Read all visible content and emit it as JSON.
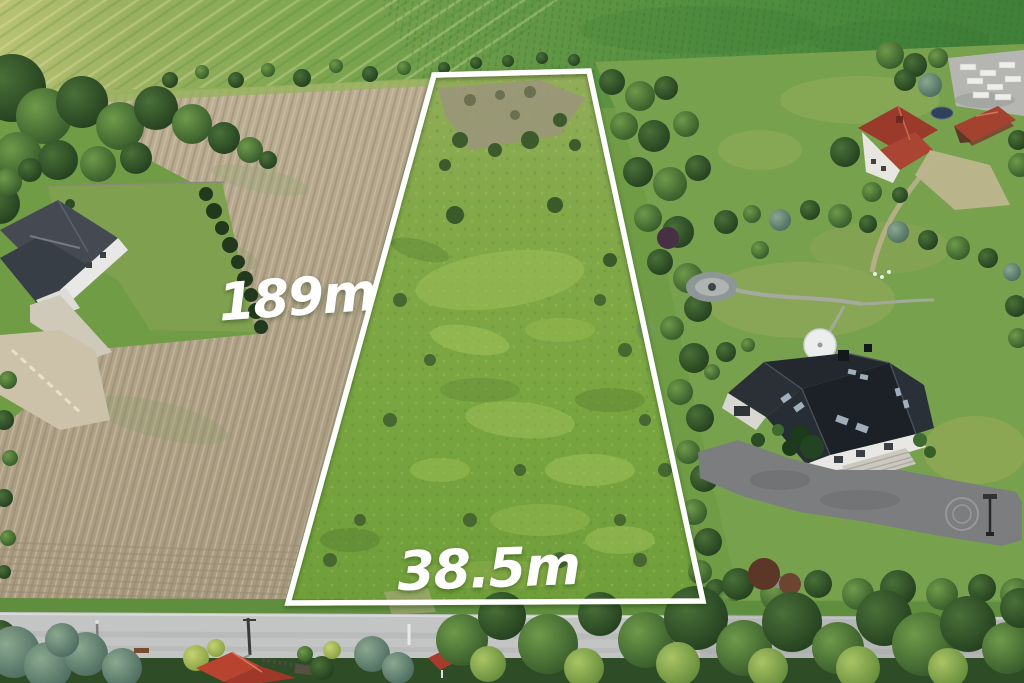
{
  "photo": {
    "type": "aerial-drone-photo",
    "subject": "rural land plot for sale marked with white boundary and dimension labels"
  },
  "overlay": {
    "length_label": "189m",
    "width_label": "38.5m",
    "boundary_color": "#ffffff",
    "label_color": "#ffffff"
  },
  "colors": {
    "meadow_plot": "#7aa641",
    "plowed_field": "#b3a68c",
    "crop_field_top": "#5f9544",
    "road": "#c3c5c4",
    "driveway_asphalt": "#7b7d7f",
    "dark_roof": "#23282e",
    "red_roof": "#9e3d2e",
    "conifer": "#2f4d2b"
  }
}
